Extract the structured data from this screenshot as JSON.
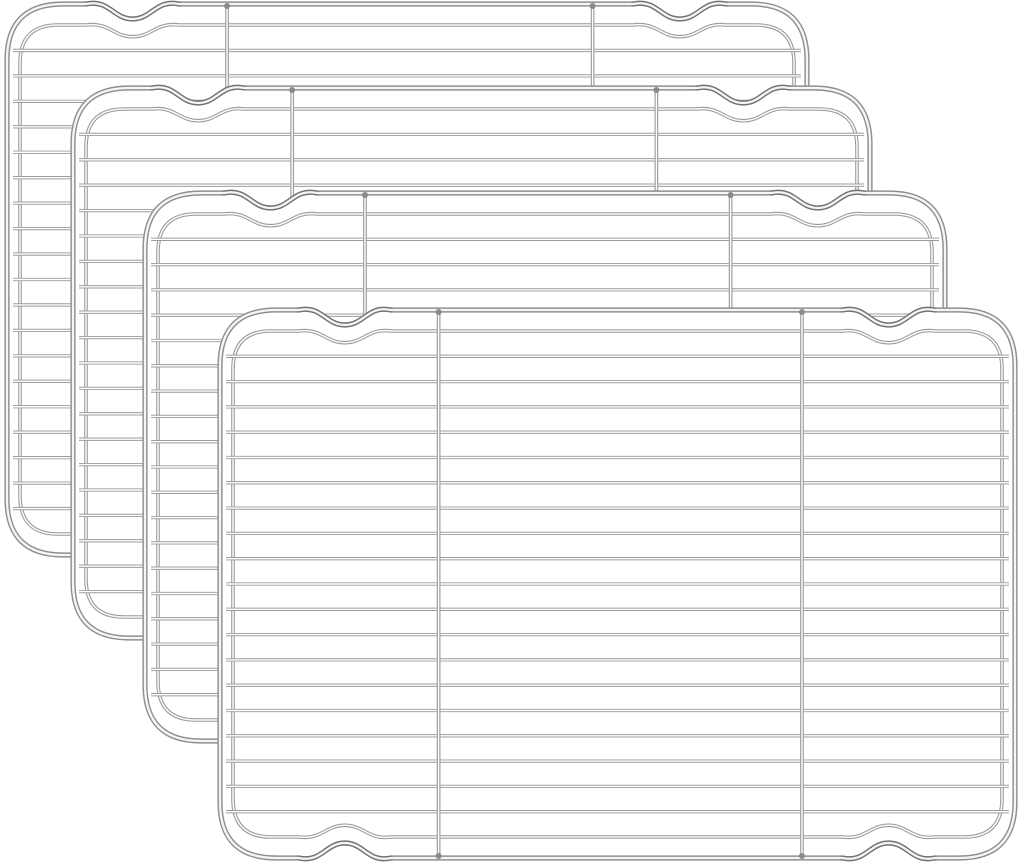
{
  "page": {
    "type": "product-image",
    "background": "#ffffff",
    "width": 1024,
    "height": 862
  },
  "product": {
    "name": "stainless-steel-cooling-racks",
    "item_count": 4,
    "finish": "chrome"
  },
  "rack_style": {
    "fill": "#ffffff",
    "frame_stroke": "#8f8f8f",
    "frame_core": "#f6f6f6",
    "frame_width": 5.2,
    "frame_core_width": 2.3,
    "wire_stroke": "#9c9c9c",
    "wire_core": "#ffffff",
    "wire_width": 3.3,
    "wire_core_width": 1.4,
    "rim_stroke": "#999999",
    "rim_core": "#fbfbfb",
    "rim_width": 3.6,
    "rim_core_width": 1.5,
    "accent_stroke": "#5e5e5e",
    "joint_color": "#8a8a8a",
    "corner_radius": 56,
    "rim_corner_radius": 38,
    "rim_inset_x": 13,
    "rim_inset_y": 21,
    "wire_count": 19,
    "wire_margin_x": 6,
    "vertical_bars": [
      0.275,
      0.732
    ],
    "wave": {
      "left_center": 0.157,
      "right_center": 0.841,
      "half_width": 0.058,
      "depth": 15,
      "bump": 5,
      "rim_depth_scale": 0.78,
      "rim_bump_scale": 0.6
    }
  },
  "racks": [
    {
      "id": "rack-1",
      "x": 7,
      "y": 4,
      "width": 800,
      "height": 551
    },
    {
      "id": "rack-2",
      "x": 73,
      "y": 88,
      "width": 797,
      "height": 550
    },
    {
      "id": "rack-3",
      "x": 145,
      "y": 193,
      "width": 800,
      "height": 548
    },
    {
      "id": "rack-4",
      "x": 220,
      "y": 310,
      "width": 795,
      "height": 548
    }
  ]
}
